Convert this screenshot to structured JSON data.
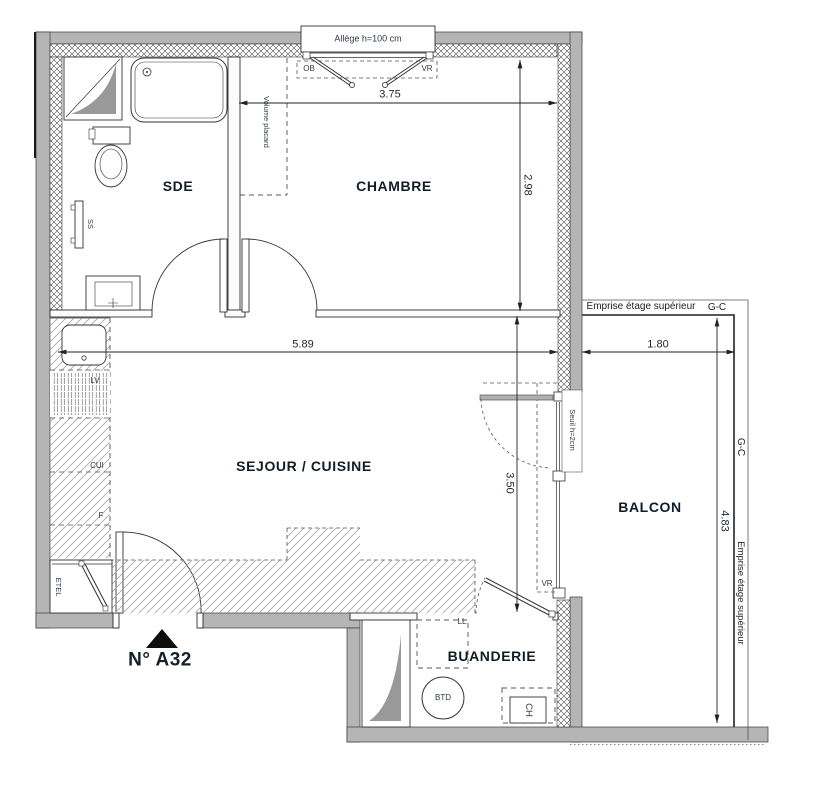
{
  "plan": {
    "unit_label": "N° A32",
    "rooms": {
      "sde": "SDE",
      "chambre": "CHAMBRE",
      "sejour": "SEJOUR / CUISINE",
      "balcon": "BALCON",
      "buanderie": "BUANDERIE"
    },
    "equipment": {
      "lv": "LV",
      "cui": "CUI",
      "f": "F",
      "etel": "ETEL",
      "ss": "SS",
      "ll": "LL",
      "btd": "BTD",
      "ch": "CH"
    },
    "openings": {
      "allege": "Allège h=100 cm",
      "ob": "OB",
      "vr_window": "VR",
      "vr_bay": "VR",
      "seuil": "Seuil h=2cm"
    },
    "annotations": {
      "volume_placard": "Volume placard",
      "emprise_top": "Emprise étage supérieur",
      "gc_top": "G-C",
      "gc_side": "G-C",
      "emprise_side": "Emprise étage supérieur"
    },
    "dimensions": {
      "chambre_width": "3.75",
      "chambre_depth": "2.98",
      "sejour_width": "5.89",
      "sejour_depth": "3.50",
      "balcon_width": "1.80",
      "balcon_depth": "4.83"
    },
    "colors": {
      "wall_fill": "#b5b5b5",
      "line": "#2b2b2b",
      "label": "#2c3a47",
      "room_label": "#111c26",
      "hatch": "#a7abb0",
      "shaft_fill": "#999999"
    }
  }
}
